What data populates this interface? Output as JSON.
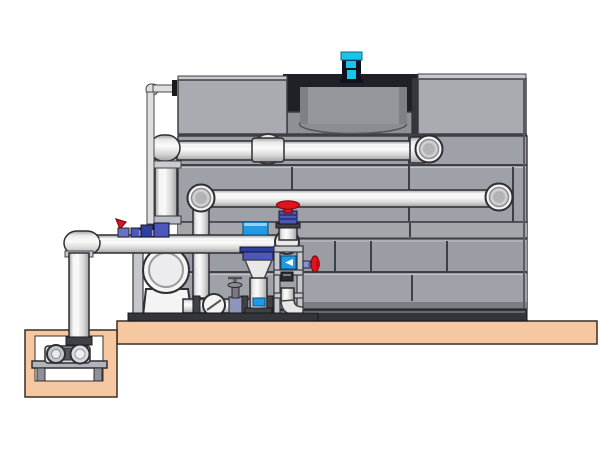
{
  "title": "Cooling tower and pump skid system illustration",
  "scene": {
    "description": "3D CAD rendering of a panel-type cooling tower on a concrete foundation with fan motor, two distribution pipes entering the tower, a pump skid with centrifugal pump, control valve riser and support frame, and a sump pit with horizontal pump feeding a vertical riser",
    "components": [
      "cooling-tower-tank",
      "fan-shroud",
      "fan-motor",
      "upper-distribution-pipe",
      "lower-distribution-pipe",
      "tank-outlet-pipe",
      "overflow-pipe",
      "suction-header",
      "sump-riser",
      "sump-pit",
      "sump-pump",
      "centrifugal-pump",
      "check-valve",
      "gate-valve",
      "discharge-control-valve",
      "red-handwheel-valve",
      "side-handwheel-valve",
      "instrument-frame",
      "foundation-slab",
      "skid-base"
    ]
  },
  "colors": {
    "background": "#ffffff",
    "panel_gray": "#9fa1a8",
    "panel_gray_light": "#a9abb1",
    "panel_gray_dark": "#8e9096",
    "panel_top_face": "#c7c9cd",
    "panel_edge": "#3e4046",
    "panel_seam_light": "#c2c4ca",
    "recess_dark": "#1f2127",
    "shroud_gray": "#94969c",
    "shroud_shadow": "#7e8086",
    "pipe_light": "#dedede",
    "pipe_shade": "#a0a0a0",
    "pipe_bright": "#fbfbfb",
    "pipe_mid": "#d5d5d5",
    "outline": "#2e2e34",
    "flange_gray": "#3f4147",
    "collar_gray": "#c9cbce",
    "pump_white": "#f4f4f4",
    "frame_gray": "#c5c7cc",
    "valve_blue": "#4a58bc",
    "valve_blue_dark": "#2f3f9e",
    "control_blue": "#1e9ae6",
    "valve_red": "#e0131c",
    "skid_dark": "#33353b",
    "slab_tan": "#f6c8a2",
    "slab_edge": "#3c2d22",
    "motor_cyan": "#17c5ea",
    "motor_dark": "#10131f"
  }
}
